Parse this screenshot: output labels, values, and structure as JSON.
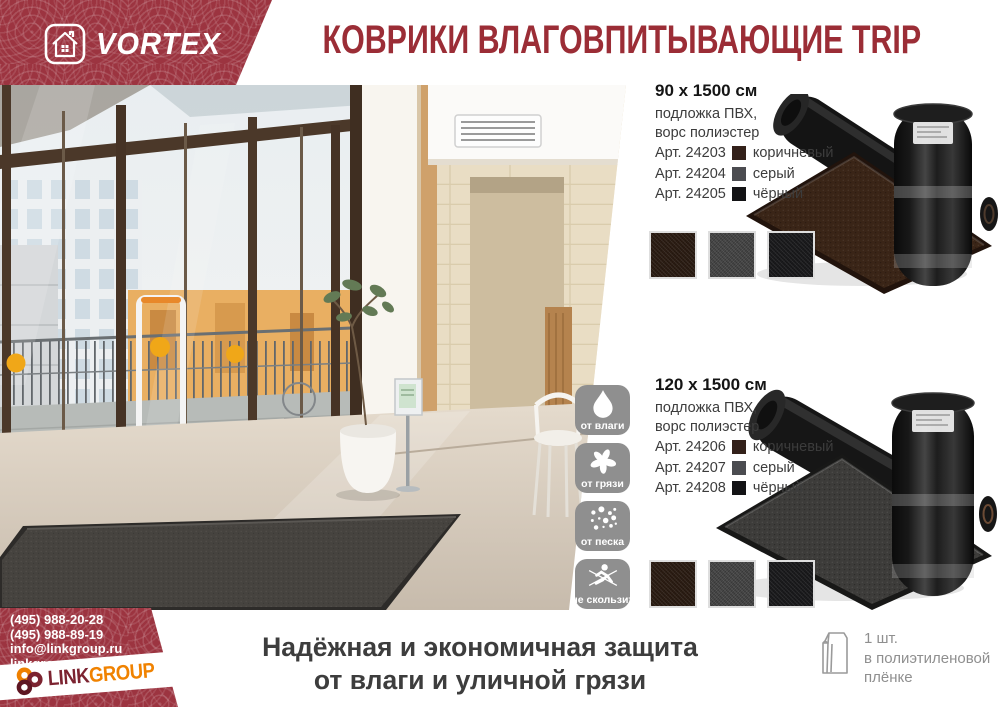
{
  "brand": {
    "name": "VORTEX"
  },
  "header": {
    "title": "КОВРИКИ ВЛАГОВПИТЫВАЮЩИЕ TRIP"
  },
  "products": [
    {
      "size": "90 х 1500 см",
      "spec_line1": "подложка ПВХ,",
      "spec_line2": "ворс полиэстер",
      "variants": [
        {
          "art": "Арт. 24203",
          "color_name": "коричневый",
          "hex": "#33211a"
        },
        {
          "art": "Арт. 24204",
          "color_name": "серый",
          "hex": "#4b4c50"
        },
        {
          "art": "Арт. 24205",
          "color_name": "чёрный",
          "hex": "#131315"
        }
      ],
      "swatches": [
        "#2d1d13",
        "#484848",
        "#1b1b1d"
      ],
      "image_mat_hex": "#3a2517"
    },
    {
      "size": "120 х 1500 см",
      "spec_line1": "подложка ПВХ,",
      "spec_line2": "ворс полиэстер",
      "variants": [
        {
          "art": "Арт. 24206",
          "color_name": "коричневый",
          "hex": "#33211a"
        },
        {
          "art": "Арт. 24207",
          "color_name": "серый",
          "hex": "#4b4c50"
        },
        {
          "art": "Арт. 24208",
          "color_name": "чёрный",
          "hex": "#131315"
        }
      ],
      "swatches": [
        "#2d1d13",
        "#484848",
        "#1b1b1d"
      ],
      "image_mat_hex": "#3d3c3a"
    }
  ],
  "features": [
    {
      "label": "от влаги",
      "icon": "water-drop-icon"
    },
    {
      "label": "от грязи",
      "icon": "dirt-splat-icon"
    },
    {
      "label": "от песка",
      "icon": "sand-dots-icon"
    },
    {
      "label": "не скользит",
      "icon": "no-slip-icon"
    }
  ],
  "slogan": {
    "line1": "Надёжная и экономичная защита",
    "line2": "от влаги и уличной грязи"
  },
  "contacts": {
    "phone1": "(495) 988-20-28",
    "phone2": "(495) 988-89-19",
    "email": "info@linkgroup.ru",
    "site": "linkgroup.ru"
  },
  "footer_logo": {
    "part1": "LINK",
    "part2": "GROUP"
  },
  "packaging": {
    "line1": "1 шт.",
    "line2": "в полиэтиленовой",
    "line3": "плёнке"
  },
  "colors": {
    "brand_red": "#9c3440",
    "title_red": "#9b2d36",
    "tile_gray": "#8f8f8f",
    "footer_maroon": "#7c2330",
    "footer_orange": "#f08200"
  }
}
